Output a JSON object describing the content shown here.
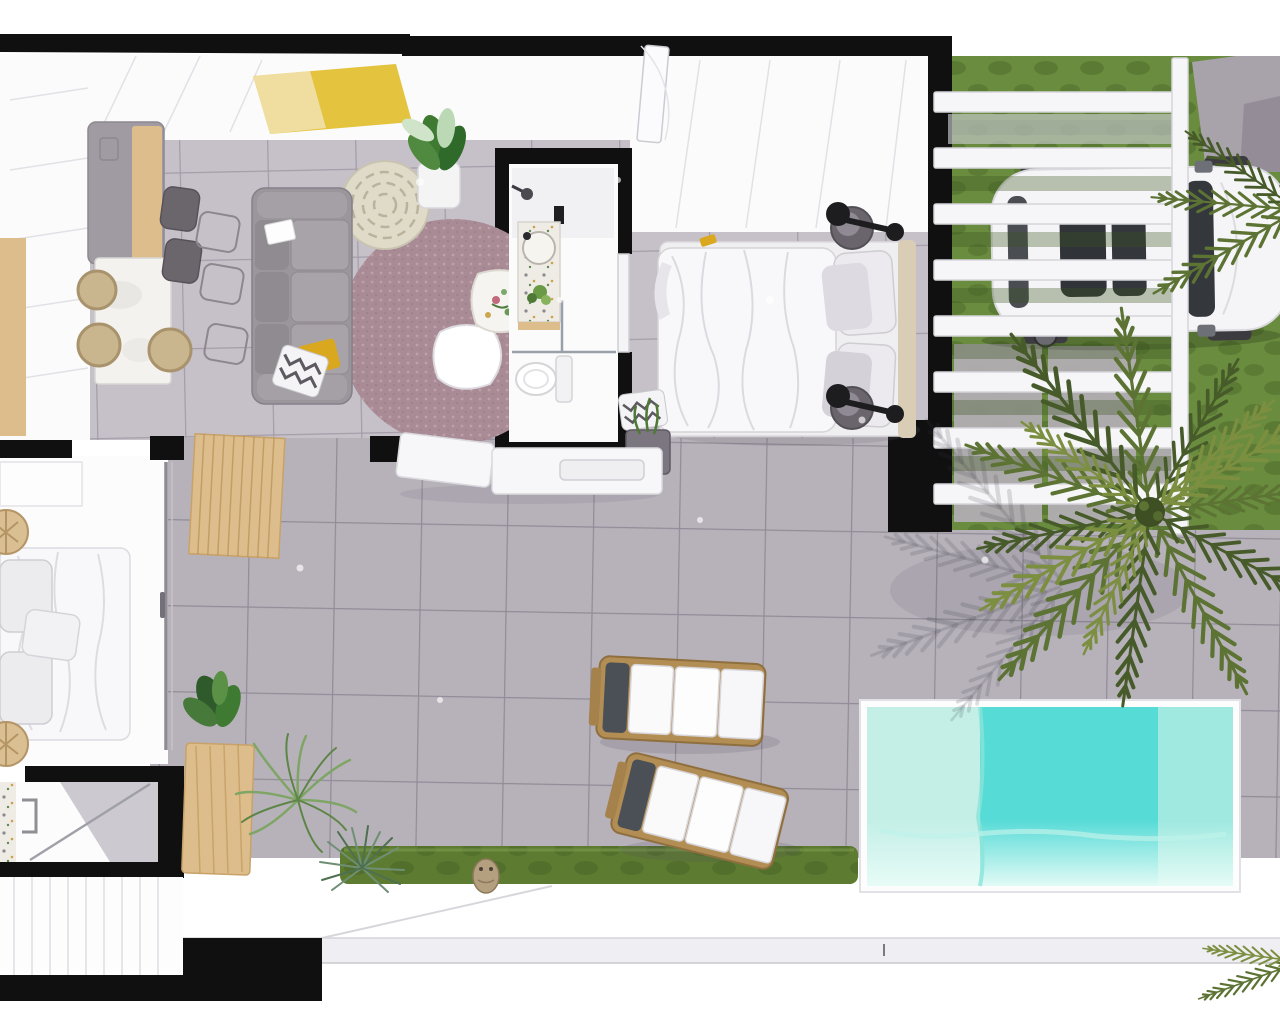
{
  "scene": {
    "type": "3d-floor-plan-render",
    "view": "top-down",
    "description": "Top-down 3D architectural rendering of a single-storey apartment with open living-kitchen, two bedrooms, two bathrooms, tiled terrace with sun loungers, plunge pool, hedge, lawn carport under a white pergola with a parked car, and a large palm tree"
  },
  "palette": {
    "wall": "#101010",
    "white_wall": "#fbfbfc",
    "wall_line": "#e2e1e6",
    "tile_indoor": "#c6c1c8",
    "tile_indoor_grout": "#a49daa",
    "tile_outdoor": "#b7b2ba",
    "tile_outdoor_grout": "#928c98",
    "pool_water": "#57dbd7",
    "pool_shelf": "#c3efe7",
    "pool_wall": "#9fe9e0",
    "pool_glow": "#e9fcf7",
    "grass": "#6a8c3e",
    "grass_shadow": "#3c5520",
    "hedge": "#5d7c31",
    "lawn_pad": "#b4aeb6",
    "wood": "#ddbd8b",
    "wood_dark": "#c8a269",
    "marble": "#f3f2ef",
    "island": "#a09ba2",
    "sofa": "#9b959c",
    "sofa_seat": "#a8a2a9",
    "rug": "#a98b95",
    "rug_dot": "#c2a5ad",
    "pouf": "#e0dbc9",
    "accent_yellow": "#e4c33e",
    "pillow_yellow": "#d9a81e",
    "plant": "#3f7a33",
    "plant_light": "#bcd9b6",
    "palm": "#5c7334",
    "palm_dark": "#475b2a",
    "palm_light": "#7c8f41",
    "car": "#f5f5f7",
    "car_glass": "#34373c",
    "lounger_wood": "#b28e55",
    "towel": "#4b5056",
    "linen": "#f8f8fa",
    "pillow_gray": "#dddae1",
    "headboard": "#d9cdb5",
    "nightstand": "#6a646d",
    "lamp": "#1d1d1f",
    "terrazzo": "#efece6",
    "console": "#f7f7f9",
    "walkway_band": "#efeef2",
    "glass": "#9aa0a8",
    "driveway": "#a8a2ab",
    "owl": "#b49f7f"
  },
  "rooms": [
    {
      "name": "kitchen-living-room",
      "objects": [
        "kitchen-island",
        "dining-table",
        "bar-stools",
        "wicker-chairs",
        "sofa",
        "round-rug",
        "coffee-table-white",
        "coffee-table-floral",
        "pouf",
        "yellow-rug",
        "potted-plant",
        "yellow-pillow",
        "zigzag-pillow"
      ]
    },
    {
      "name": "bathroom-main",
      "objects": [
        "vanity-sink",
        "shower",
        "toilet",
        "sliding-glass-door"
      ]
    },
    {
      "name": "bedroom-main",
      "objects": [
        "double-bed",
        "pillows",
        "headboard",
        "nightstand",
        "reading-lamp",
        "wardrobe",
        "planter-zigzag"
      ]
    },
    {
      "name": "bedroom-second",
      "objects": [
        "double-bed",
        "rattan-wall-decor",
        "glass-sliding-door"
      ]
    },
    {
      "name": "bathroom-second",
      "objects": [
        "shower",
        "towel-rail",
        "terrazzo-wall"
      ]
    },
    {
      "name": "hallway",
      "objects": [
        "console-sideboard",
        "wood-slat-partition",
        "entry-door"
      ]
    },
    {
      "name": "terrace",
      "objects": [
        "sun-lounger",
        "sun-lounger",
        "hedge",
        "owl-ornament",
        "yucca-plant",
        "feather-plant",
        "wood-sideboard",
        "louver-fence"
      ]
    },
    {
      "name": "pool-area",
      "objects": [
        "plunge-pool",
        "tanning-shelf"
      ]
    },
    {
      "name": "garden-carport",
      "objects": [
        "pergola",
        "car",
        "lawn",
        "stepping-stones",
        "driveway",
        "palm-tree"
      ]
    }
  ]
}
